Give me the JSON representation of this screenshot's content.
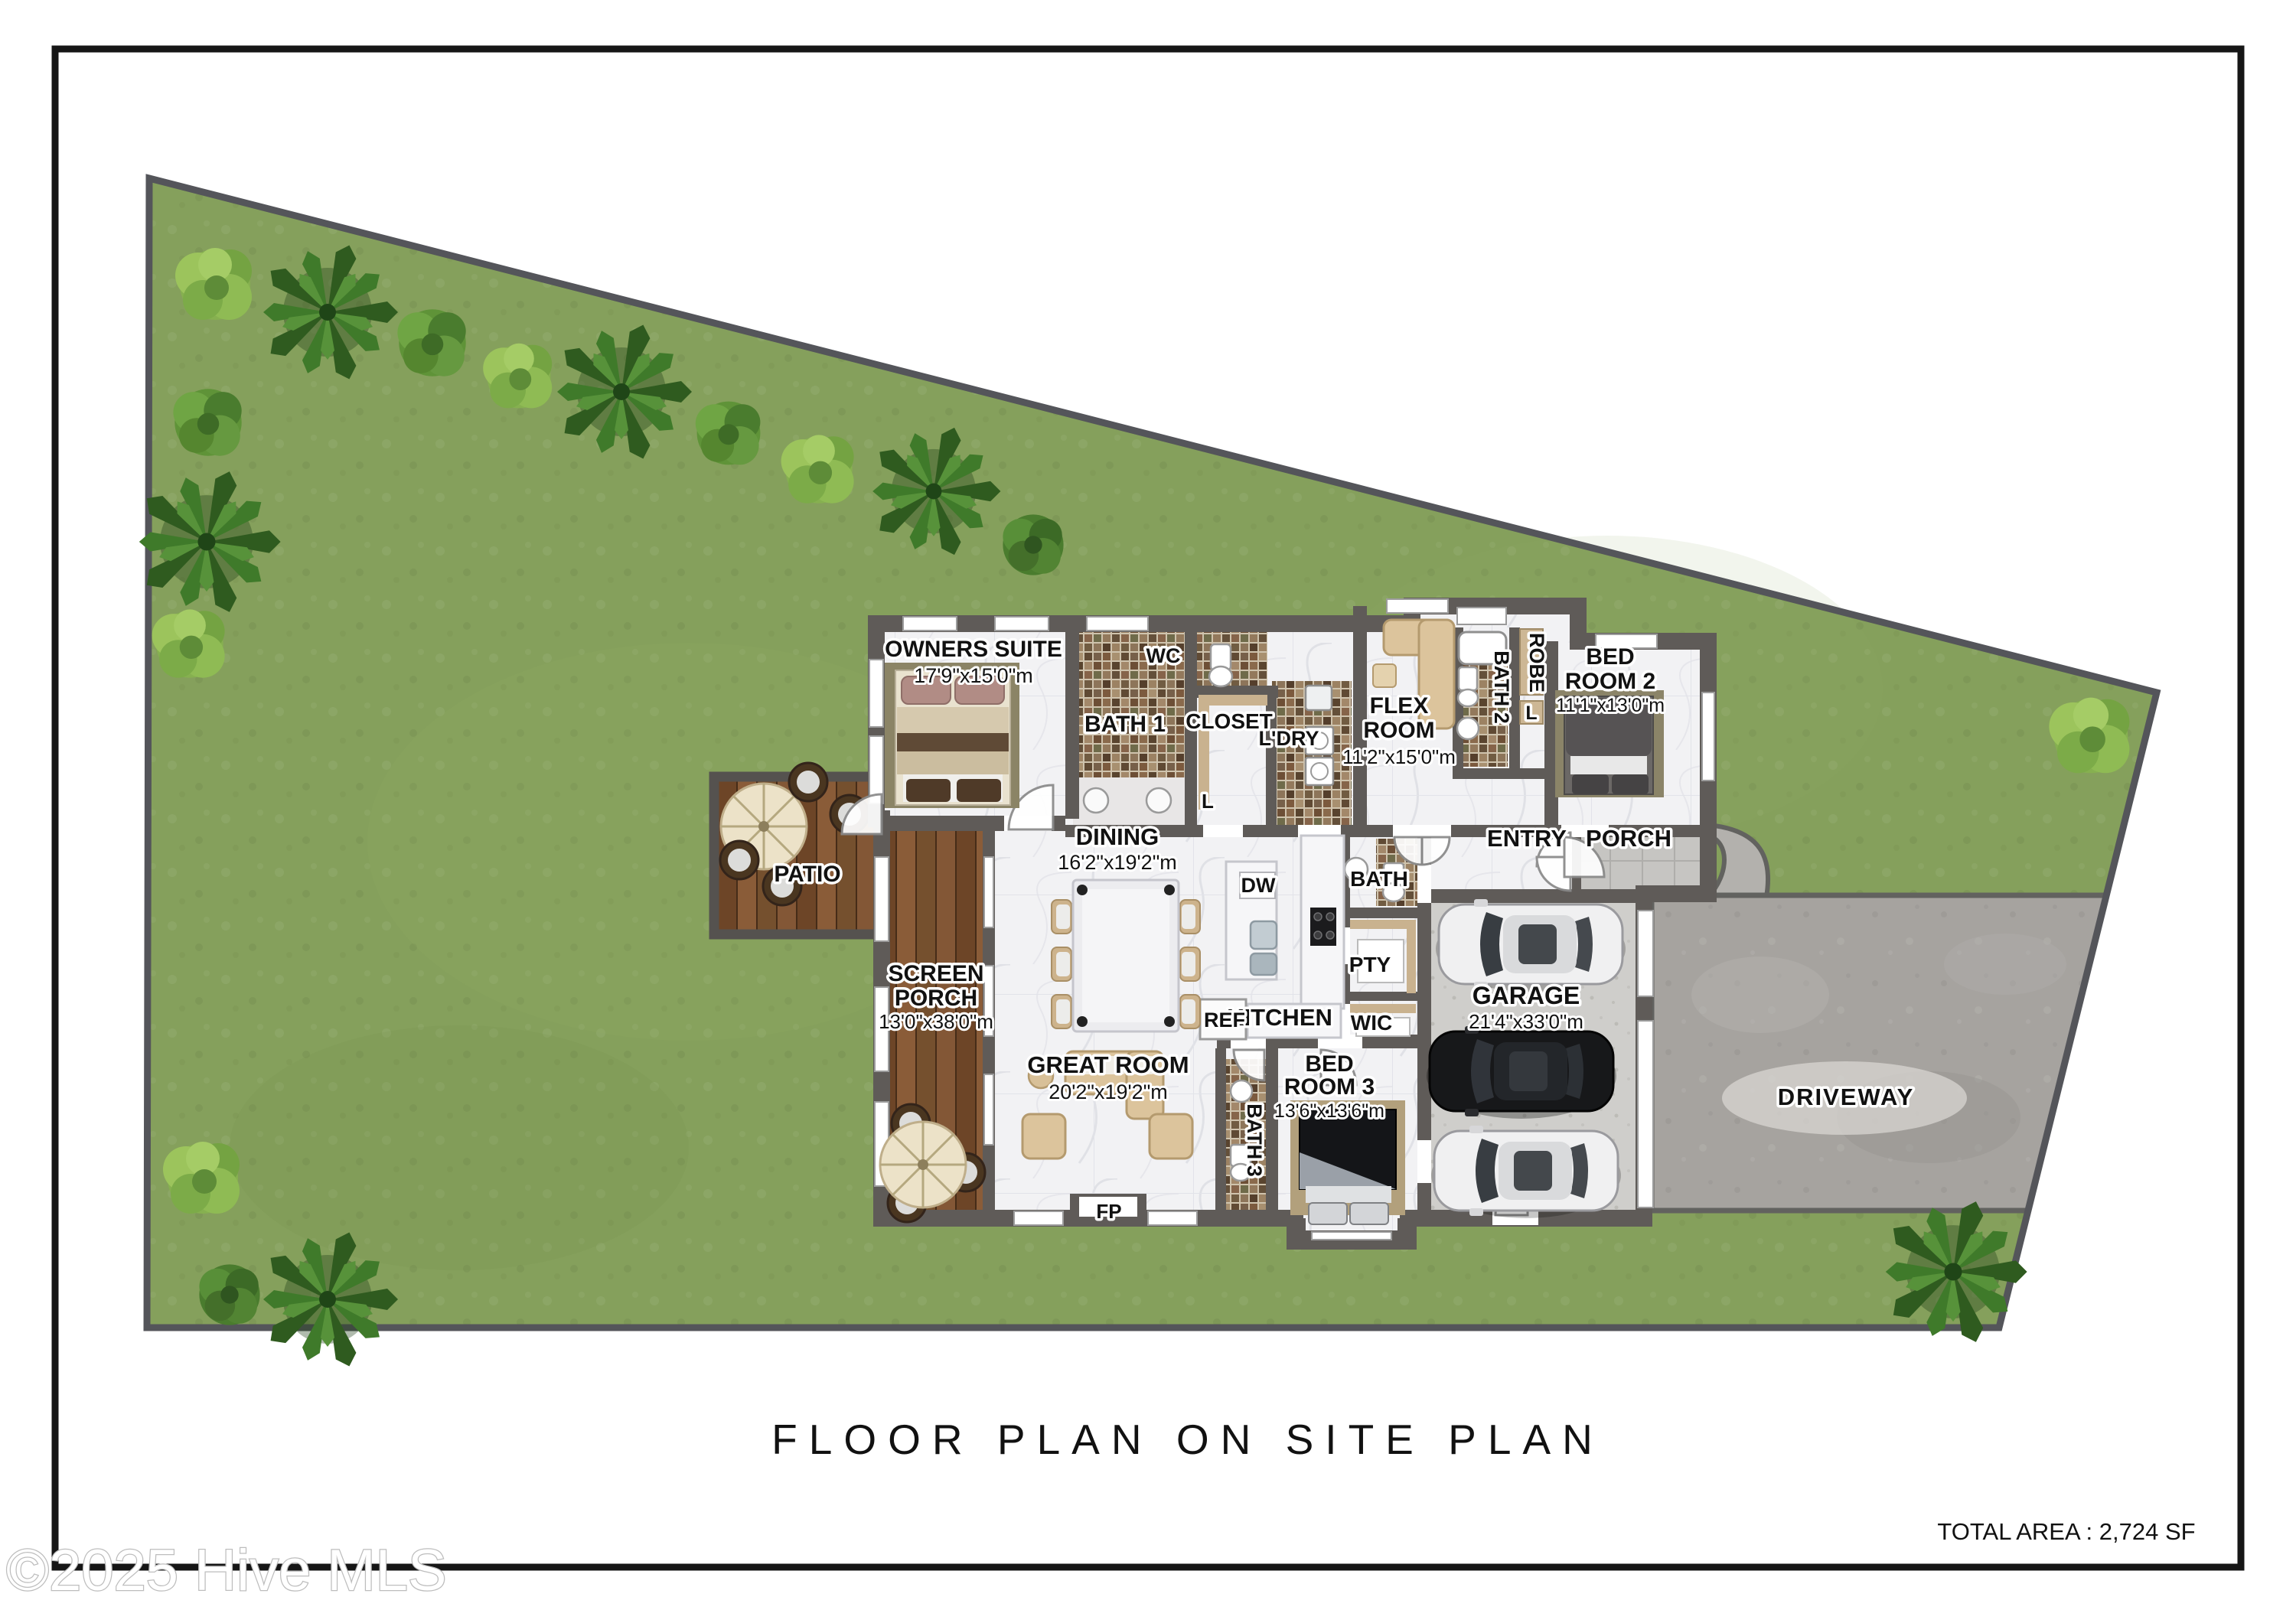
{
  "page": {
    "title": "FLOOR PLAN ON SITE PLAN",
    "total_area": "TOTAL AREA : 2,724 SF",
    "watermark": "©2025 Hive MLS"
  },
  "site": {
    "driveway": "DRIVEWAY",
    "patio": "PATIO"
  },
  "rooms": {
    "owners_suite": {
      "line1": "OWNERS SUITE",
      "dims": "17'9\"x15'0\"m"
    },
    "bath1": {
      "line1": "BATH 1"
    },
    "wc": {
      "line1": "WC"
    },
    "closet": {
      "line1": "CLOSET"
    },
    "laundry": {
      "line1": "L'DRY"
    },
    "linen1": {
      "line1": "L"
    },
    "flex": {
      "line1": "FLEX",
      "line2": "ROOM",
      "dims": "11'2\"x15'0\"m"
    },
    "bath2": {
      "line1": "BATH 2"
    },
    "robe": {
      "line1": "ROBE"
    },
    "linen2": {
      "line1": "L"
    },
    "bed2": {
      "line1": "BED",
      "line2": "ROOM 2",
      "dims": "11'1\"x13'0\"m"
    },
    "entry": {
      "line1": "ENTRY"
    },
    "porch": {
      "line1": "PORCH"
    },
    "dining": {
      "line1": "DINING",
      "dims": "16'2\"x19'2\"m"
    },
    "dw": {
      "line1": "DW"
    },
    "bath_main": {
      "line1": "BATH"
    },
    "pantry": {
      "line1": "PTY"
    },
    "kitchen": {
      "line1": "KITCHEN"
    },
    "fridge": {
      "line1": "REF"
    },
    "wic": {
      "line1": "WIC"
    },
    "great_room": {
      "line1": "GREAT ROOM",
      "dims": "20'2\"x19'2\"m"
    },
    "fireplace": {
      "line1": "FP"
    },
    "bed3": {
      "line1": "BED",
      "line2": "ROOM 3",
      "dims": "13'6\"x13'6\"m"
    },
    "bath3": {
      "line1": "BATH 3"
    },
    "screen_porch": {
      "line1": "SCREEN",
      "line2": "PORCH",
      "dims": "13'0\"x38'0\"m"
    },
    "garage": {
      "line1": "GARAGE",
      "dims": "21'4\"x33'0\"m"
    }
  },
  "colors": {
    "grass": "#85a05c",
    "lot_border": "#54555a",
    "wall": "#5f5b58",
    "floor": "#f2f2f4",
    "wood": "#7c5132",
    "driveway": "#a6a39f",
    "garage_slab": "#cfcecb",
    "accent_tan": "#c9b28f",
    "frame": "#161616"
  }
}
